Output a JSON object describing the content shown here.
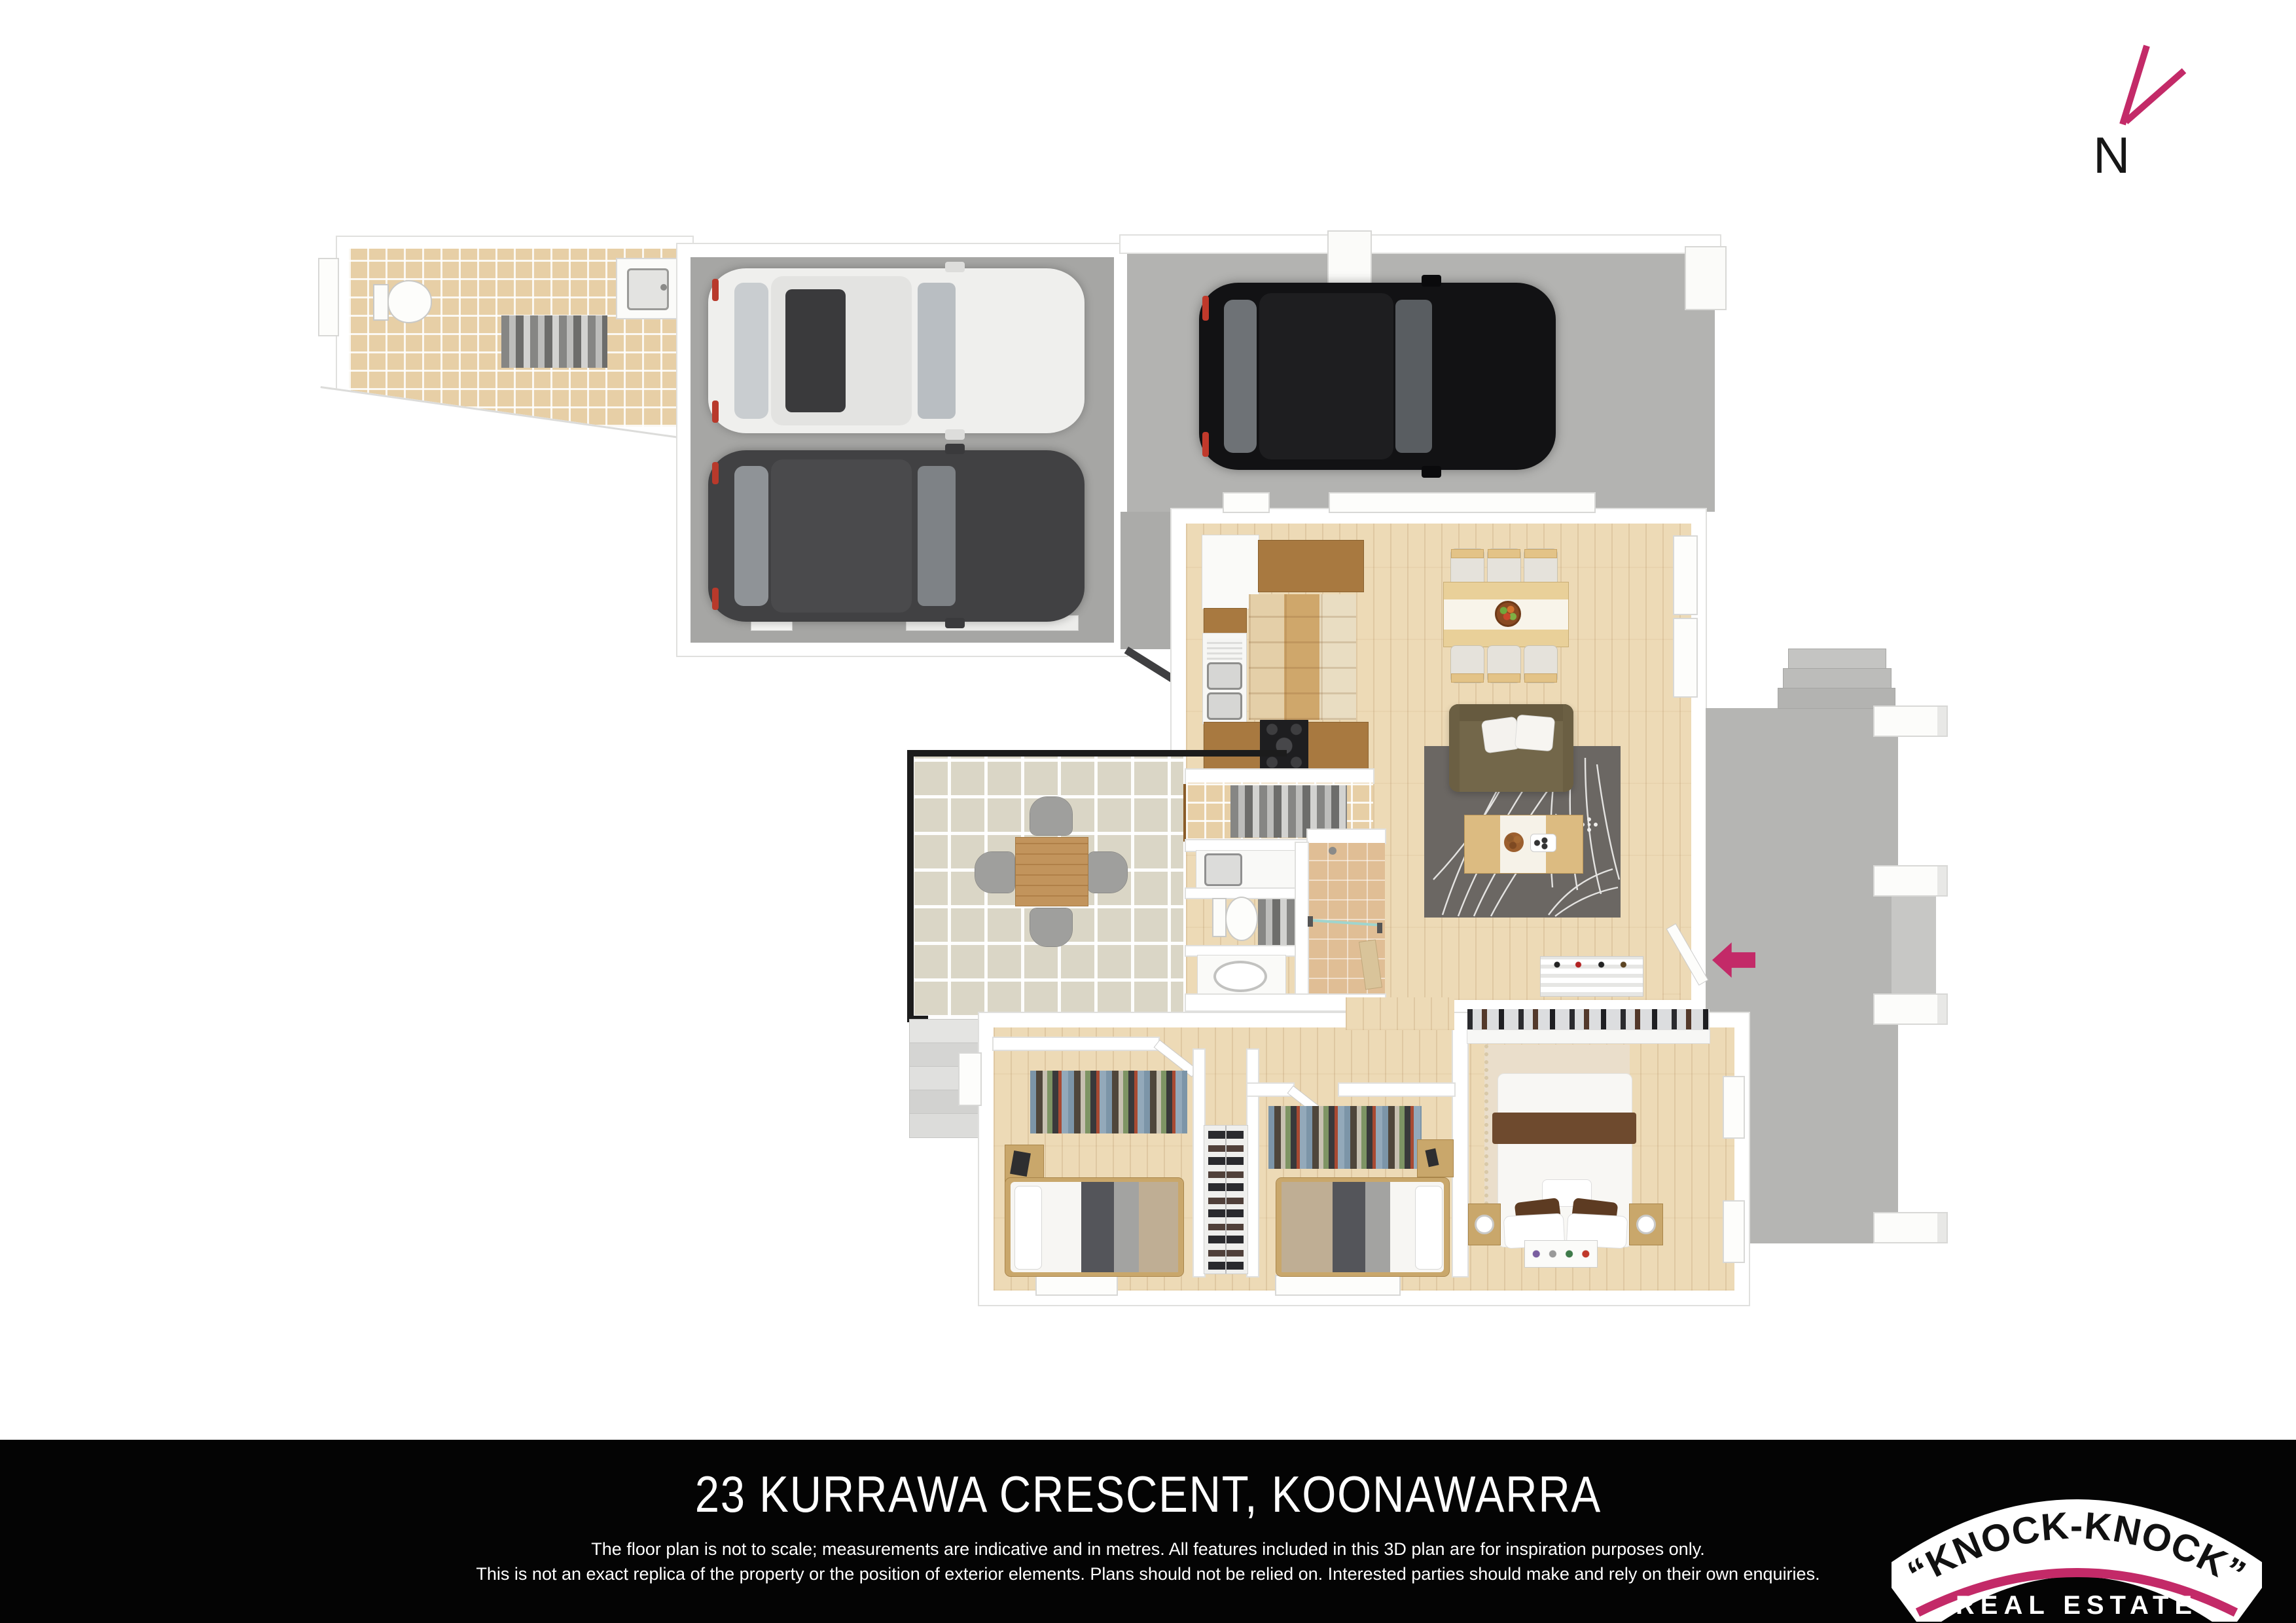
{
  "north": {
    "label": "N"
  },
  "brand": {
    "accent_color": "#C32A68",
    "logo_line1": "“KNOCK-KNOCK”",
    "logo_line2": "REAL ESTATE"
  },
  "footer": {
    "address": "23 KURRAWA CRESCENT, KOONAWARRA",
    "disclaimer_line1": "The floor plan is not to scale; measurements are indicative and in metres. All features included in this 3D plan are for inspiration purposes only.",
    "disclaimer_line2": "This is not an exact replica of the property or the position of exterior elements. Plans should not be relied on. Interested parties should make and rely on their own enquiries."
  },
  "floor_plan": {
    "type": "3d-top-down-render",
    "rooms": [
      "storeroom-wc",
      "double-garage",
      "carport",
      "kitchen",
      "dining",
      "living",
      "laundry",
      "wc",
      "bathroom",
      "alfresco-patio",
      "rear-deck",
      "hallway",
      "bedroom-2",
      "bedroom-3",
      "master-bedroom",
      "built-in-wardrobe",
      "entry"
    ],
    "cars": [
      {
        "location": "garage",
        "color": "white"
      },
      {
        "location": "garage",
        "color": "dark-grey"
      },
      {
        "location": "carport",
        "color": "black"
      }
    ],
    "entry_arrow_color": "#C32A68",
    "bed_count": 3,
    "dining_seats": 6,
    "patio_seats": 4
  }
}
